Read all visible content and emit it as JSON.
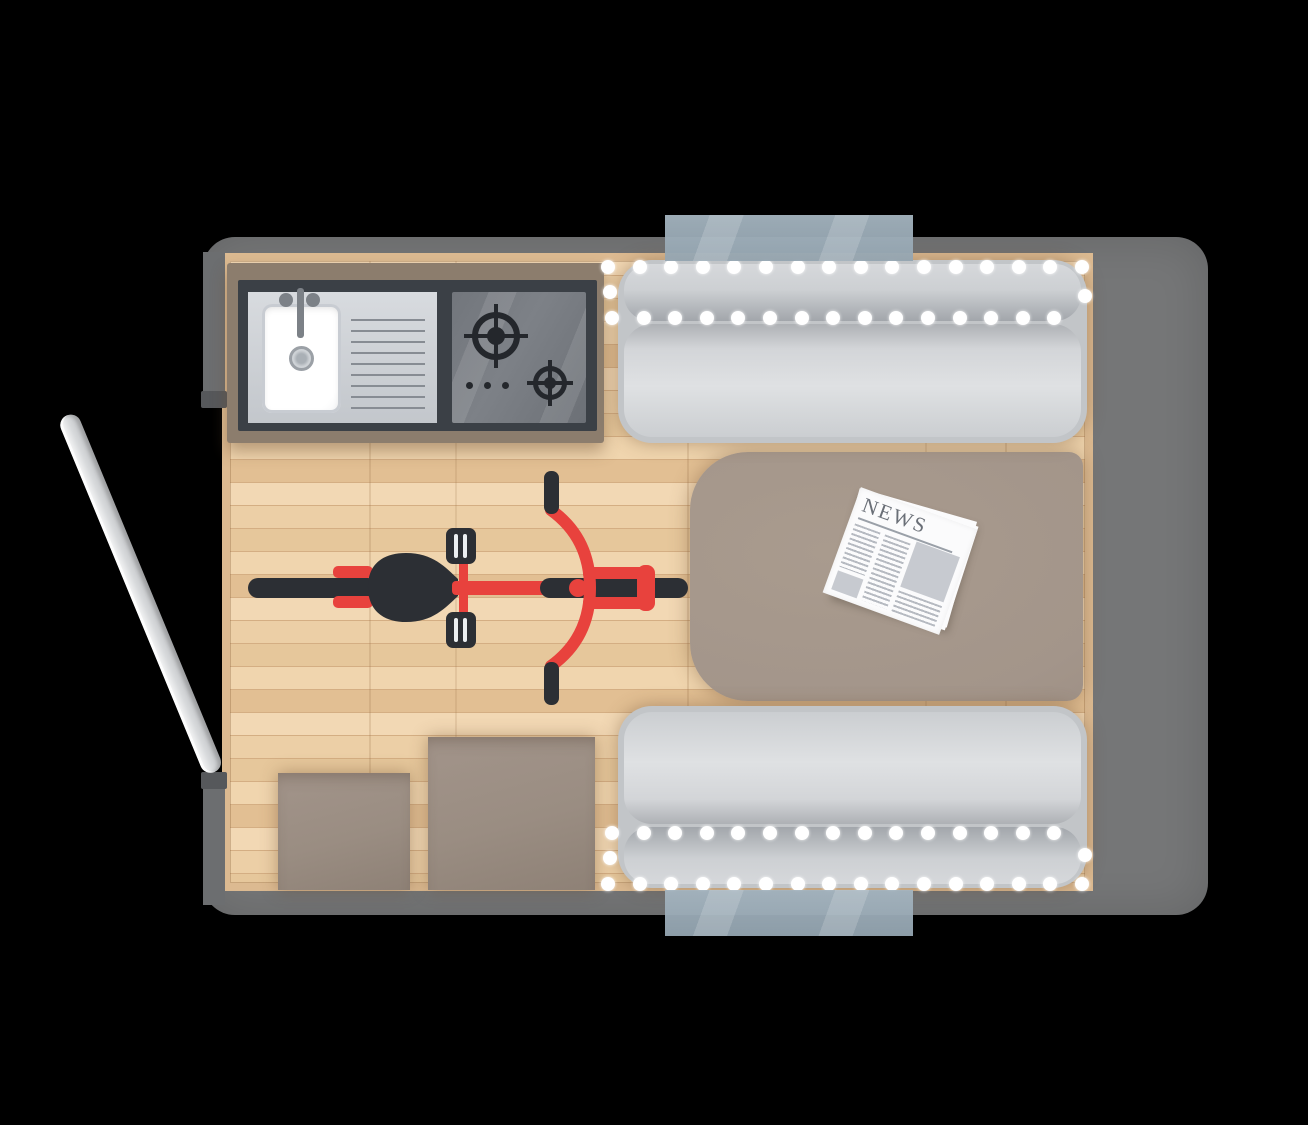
{
  "newspaper": {
    "title": "NEWS"
  },
  "colors": {
    "background": "#000000",
    "van_body": "#757677",
    "wall_shade": "#6c6e70",
    "door_jamb": "#56585b",
    "floor_plank_a": "#f2d8b4",
    "floor_plank_b": "#eccfa6",
    "floor_plank_c": "#e6c79b",
    "floor_plank_d": "#f0d5ae",
    "floor_plank_e": "#e2bf93",
    "floor_line": "#d4ae83",
    "floor_trim": "#dcba91",
    "floor_shadow": "rgba(110,80,50,0.45)",
    "kitchen_frame": "#8c7d6d",
    "kitchen_counter": "#3b4046",
    "sink_tray": "#cdd1d6",
    "sink_basin": "#ffffff",
    "fixture_gray": "#7c8187",
    "cooktop": "#75797f",
    "burner_black": "#24272c",
    "mattress": "#d3d5d8",
    "mattress_shade": "#a2a6ab",
    "led_dot": "#ffffff",
    "table_taupe": "#a3958a",
    "stool_taupe": "#9a8d82",
    "paper_white": "#fbfbfc",
    "paper_text": "#b6bac1",
    "paper_block": "#c7cad0",
    "masthead": "#6a6f77",
    "bike_red": "#e8423d",
    "bike_black": "#2c2f34",
    "window_glass": "#a4b4bf",
    "door_gray": "#d9dbdd"
  },
  "beds": [
    {
      "id": "bed-top",
      "dot_rows": [
        {
          "y": 267,
          "x": 608,
          "count": 16,
          "step": 31.6
        },
        {
          "y": 318,
          "x": 612,
          "count": 15,
          "step": 31.6
        }
      ],
      "extra_dots": [
        [
          610,
          292
        ],
        [
          1085,
          296
        ]
      ]
    },
    {
      "id": "bed-bottom",
      "dot_rows": [
        {
          "y": 833,
          "x": 612,
          "count": 15,
          "step": 31.6
        },
        {
          "y": 884,
          "x": 608,
          "count": 16,
          "step": 31.6
        }
      ],
      "extra_dots": [
        [
          610,
          858
        ],
        [
          1085,
          855
        ]
      ]
    }
  ]
}
